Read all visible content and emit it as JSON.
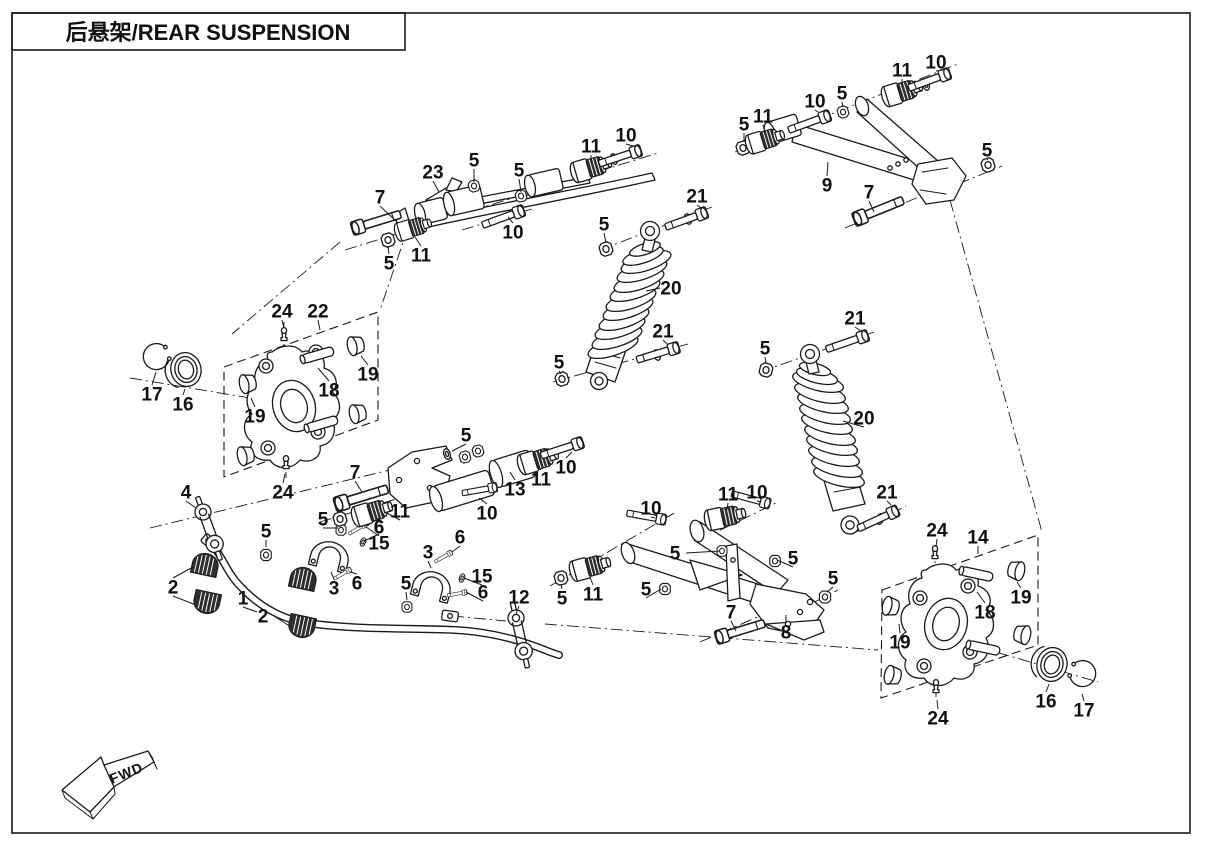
{
  "title": {
    "full": "后悬架/REAR SUSPENSION"
  },
  "fwd": {
    "label": "FWD"
  },
  "colors": {
    "ink": "#1a1a1a",
    "background": "#ffffff"
  },
  "callouts": [
    {
      "n": "7",
      "x": 380,
      "y": 197,
      "t": [
        396,
        221
      ]
    },
    {
      "n": "23",
      "x": 433,
      "y": 172,
      "t": [
        439,
        192
      ]
    },
    {
      "n": "5",
      "x": 474,
      "y": 160,
      "t": [
        474,
        182
      ]
    },
    {
      "n": "5",
      "x": 519,
      "y": 170,
      "t": [
        521,
        192
      ]
    },
    {
      "n": "11",
      "x": 591,
      "y": 146,
      "t": [
        591,
        163
      ]
    },
    {
      "n": "10",
      "x": 626,
      "y": 135,
      "t": [
        633,
        146
      ]
    },
    {
      "n": "5",
      "x": 389,
      "y": 263,
      "t": [
        388,
        246
      ]
    },
    {
      "n": "11",
      "x": 421,
      "y": 255,
      "t": [
        415,
        237
      ]
    },
    {
      "n": "10",
      "x": 513,
      "y": 232,
      "t": [
        508,
        217
      ]
    },
    {
      "n": "21",
      "x": 697,
      "y": 196,
      "t": [
        701,
        208
      ]
    },
    {
      "n": "5",
      "x": 604,
      "y": 224,
      "t": [
        606,
        243
      ]
    },
    {
      "n": "20",
      "x": 671,
      "y": 288,
      "t": [
        646,
        291
      ]
    },
    {
      "n": "21",
      "x": 663,
      "y": 331,
      "t": [
        668,
        345
      ]
    },
    {
      "n": "5",
      "x": 559,
      "y": 362,
      "t": [
        561,
        374
      ]
    },
    {
      "n": "11",
      "x": 902,
      "y": 70,
      "t": [
        902,
        86
      ]
    },
    {
      "n": "10",
      "x": 936,
      "y": 62,
      "t": [
        943,
        70
      ]
    },
    {
      "n": "10",
      "x": 815,
      "y": 101,
      "t": [
        818,
        112
      ]
    },
    {
      "n": "5",
      "x": 842,
      "y": 93,
      "t": [
        843,
        107
      ]
    },
    {
      "n": "5",
      "x": 744,
      "y": 124,
      "t": [
        744,
        142
      ]
    },
    {
      "n": "11",
      "x": 763,
      "y": 116,
      "t": [
        765,
        133
      ]
    },
    {
      "n": "9",
      "x": 827,
      "y": 185,
      "t": [
        828,
        162
      ]
    },
    {
      "n": "7",
      "x": 869,
      "y": 192,
      "t": [
        874,
        212
      ]
    },
    {
      "n": "5",
      "x": 987,
      "y": 150,
      "t": [
        988,
        160
      ]
    },
    {
      "n": "24",
      "x": 282,
      "y": 311,
      "t": [
        284,
        328
      ]
    },
    {
      "n": "22",
      "x": 318,
      "y": 311,
      "t": [
        320,
        330
      ]
    },
    {
      "n": "17",
      "x": 152,
      "y": 394,
      "t": [
        156,
        372
      ]
    },
    {
      "n": "16",
      "x": 183,
      "y": 404,
      "t": [
        185,
        389
      ]
    },
    {
      "n": "19",
      "x": 255,
      "y": 416,
      "t": [
        251,
        398
      ]
    },
    {
      "n": "18",
      "x": 329,
      "y": 390,
      "t": [
        318,
        368
      ]
    },
    {
      "n": "19",
      "x": 368,
      "y": 374,
      "t": [
        361,
        356
      ]
    },
    {
      "n": "24",
      "x": 283,
      "y": 492,
      "t": [
        285,
        474
      ]
    },
    {
      "n": "4",
      "x": 186,
      "y": 492,
      "t": [
        196,
        508
      ]
    },
    {
      "n": "5",
      "x": 266,
      "y": 531,
      "t": [
        266,
        547
      ]
    },
    {
      "n": "2",
      "x": 173,
      "y": 587,
      "t": [
        193,
        567
      ],
      "t2": [
        196,
        605
      ]
    },
    {
      "n": "1",
      "x": 243,
      "y": 598,
      "t": [
        257,
        612
      ]
    },
    {
      "n": "2",
      "x": 263,
      "y": 616,
      "t": [
        291,
        627
      ]
    },
    {
      "n": "3",
      "x": 334,
      "y": 588,
      "t": [
        331,
        572
      ]
    },
    {
      "n": "6",
      "x": 357,
      "y": 583,
      "t": [
        350,
        572
      ]
    },
    {
      "n": "5",
      "x": 323,
      "y": 519,
      "t": [
        338,
        528
      ]
    },
    {
      "n": "6",
      "x": 379,
      "y": 527,
      "t": [
        367,
        526
      ]
    },
    {
      "n": "15",
      "x": 379,
      "y": 543,
      "t": [
        364,
        541
      ]
    },
    {
      "n": "3",
      "x": 428,
      "y": 552,
      "t": [
        431,
        568
      ]
    },
    {
      "n": "6",
      "x": 460,
      "y": 537,
      "t": [
        452,
        552
      ]
    },
    {
      "n": "15",
      "x": 482,
      "y": 576,
      "t": [
        464,
        578
      ]
    },
    {
      "n": "6",
      "x": 483,
      "y": 592,
      "t": [
        466,
        592
      ]
    },
    {
      "n": "5",
      "x": 406,
      "y": 583,
      "t": [
        407,
        600
      ]
    },
    {
      "n": "12",
      "x": 519,
      "y": 597,
      "t": [
        516,
        614
      ]
    },
    {
      "n": "5",
      "x": 466,
      "y": 435,
      "t": [
        452,
        451
      ]
    },
    {
      "n": "7",
      "x": 355,
      "y": 472,
      "t": [
        362,
        492
      ]
    },
    {
      "n": "13",
      "x": 515,
      "y": 489,
      "t": [
        510,
        472
      ]
    },
    {
      "n": "11",
      "x": 541,
      "y": 479,
      "t": [
        536,
        464
      ]
    },
    {
      "n": "10",
      "x": 566,
      "y": 467,
      "t": [
        572,
        452
      ]
    },
    {
      "n": "10",
      "x": 487,
      "y": 513,
      "t": [
        479,
        498
      ]
    },
    {
      "n": "11",
      "x": 400,
      "y": 511,
      "t": [
        385,
        512
      ]
    },
    {
      "n": "6",
      "x": 379,
      "y": 527,
      "t": [
        366,
        527
      ]
    },
    {
      "n": "10",
      "x": 651,
      "y": 508,
      "t": [
        655,
        518
      ]
    },
    {
      "n": "11",
      "x": 728,
      "y": 494,
      "t": [
        727,
        510
      ]
    },
    {
      "n": "10",
      "x": 757,
      "y": 492,
      "t": [
        761,
        502
      ]
    },
    {
      "n": "5",
      "x": 675,
      "y": 553,
      "t": [
        720,
        551
      ]
    },
    {
      "n": "5",
      "x": 793,
      "y": 558,
      "t": [
        777,
        560
      ]
    },
    {
      "n": "11",
      "x": 593,
      "y": 594,
      "t": [
        590,
        577
      ]
    },
    {
      "n": "5",
      "x": 562,
      "y": 598,
      "t": [
        561,
        584
      ]
    },
    {
      "n": "5",
      "x": 646,
      "y": 589,
      "t": [
        661,
        589
      ]
    },
    {
      "n": "7",
      "x": 731,
      "y": 612,
      "t": [
        736,
        631
      ]
    },
    {
      "n": "8",
      "x": 786,
      "y": 632,
      "t": [
        786,
        615
      ]
    },
    {
      "n": "5",
      "x": 833,
      "y": 578,
      "t": [
        827,
        592
      ]
    },
    {
      "n": "21",
      "x": 855,
      "y": 318,
      "t": [
        861,
        331
      ]
    },
    {
      "n": "5",
      "x": 765,
      "y": 348,
      "t": [
        766,
        363
      ]
    },
    {
      "n": "20",
      "x": 864,
      "y": 418,
      "t": [
        843,
        421
      ]
    },
    {
      "n": "21",
      "x": 887,
      "y": 492,
      "t": [
        891,
        505
      ]
    },
    {
      "n": "24",
      "x": 937,
      "y": 530,
      "t": [
        936,
        547
      ]
    },
    {
      "n": "14",
      "x": 978,
      "y": 537,
      "t": [
        978,
        554
      ]
    },
    {
      "n": "19",
      "x": 1021,
      "y": 597,
      "t": [
        1017,
        582
      ]
    },
    {
      "n": "18",
      "x": 985,
      "y": 612,
      "t": [
        977,
        592
      ]
    },
    {
      "n": "19",
      "x": 900,
      "y": 642,
      "t": [
        899,
        624
      ]
    },
    {
      "n": "16",
      "x": 1046,
      "y": 701,
      "t": [
        1049,
        684
      ]
    },
    {
      "n": "17",
      "x": 1084,
      "y": 710,
      "t": [
        1082,
        694
      ]
    },
    {
      "n": "24",
      "x": 938,
      "y": 718,
      "t": [
        937,
        700
      ]
    }
  ]
}
